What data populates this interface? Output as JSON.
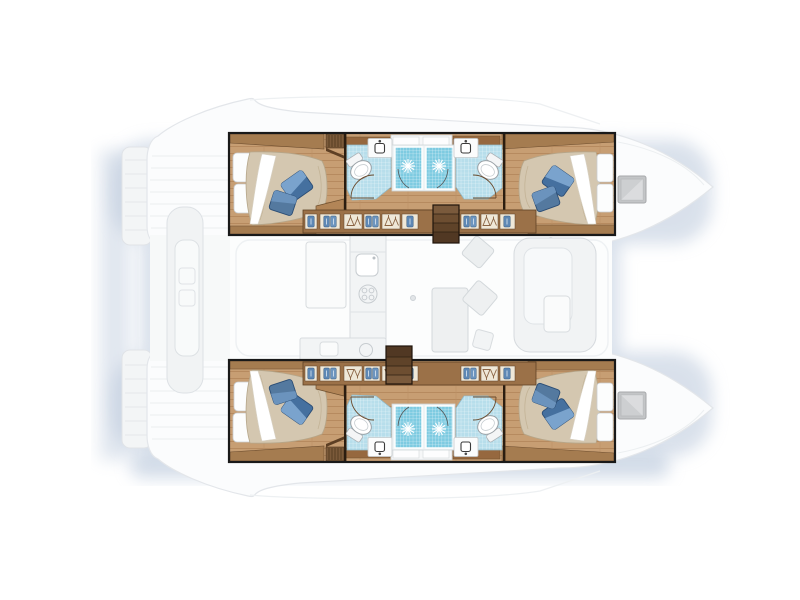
{
  "diagram": {
    "type": "yacht-floor-plan",
    "vessel": "sailing-catamaran",
    "view": "top-down accommodation and deck plan",
    "orientation": "bows-pointing-right",
    "hulls": [
      {
        "name": "port-hull-top",
        "spaces": [
          "aft double cabin with berth and pillows",
          "aft head with sink and toilet",
          "two shower stalls",
          "forward head with sink and toilet",
          "forward double cabin with berth and pillows",
          "corridor with hanging lockers",
          "companionway steps"
        ]
      },
      {
        "name": "starboard-hull-bottom",
        "spaces": [
          "aft double cabin with berth and pillows",
          "aft head with sink and toilet",
          "two shower stalls",
          "forward head with sink and toilet",
          "forward double cabin with berth and pillows",
          "corridor with hanging lockers",
          "companionway steps"
        ]
      }
    ],
    "bridge_deck": {
      "rendering": "ghosted",
      "spaces": [
        "salon",
        "galley with sink and stove",
        "dining table with chairs",
        "l-shaped sofa",
        "aft cockpit bench and table",
        "twin stern swim platforms",
        "foredeck with deck hatches"
      ]
    },
    "counts": {
      "double_berths": 4,
      "shower_stalls": 4,
      "toilets": 4,
      "head_sinks": 4,
      "deck_hatches": 2,
      "companionway_steps": 2
    }
  },
  "colors": {
    "background": "#ffffff",
    "shadow": "#b4c3d8",
    "deck_fill": "#fbfcfd",
    "deck_line": "#e3e6ea",
    "ghost_fill": "#f1f3f4",
    "ghost_line": "#dde1e5",
    "outline_black": "#191919",
    "wood_floor": "#c79e73",
    "wood_plank": "#b2865a",
    "wood_trim": "#a57c50",
    "wood_dark": "#7b5a3a",
    "wood_edge": "#6e4e2f",
    "steps_light": "#7a5a3c",
    "steps_dark": "#513823",
    "mattress": "#d4c7b0",
    "sheet_white": "#ffffff",
    "pillow_white": "#fcfdfd",
    "pillow_blue_light": "#7aa3cd",
    "pillow_blue": "#45709f",
    "pillow_blue_mid": "#54799f",
    "head_tile": "#b7deeb",
    "shower_tile": "#7ecbe1",
    "porcelain": "#ffffff",
    "porcelain_line": "#9aa1a6",
    "locker_row": "#9b7148",
    "locker_cell": "#efe8d8",
    "towel_blue": "#5e88b5",
    "hatch_gray": "#c3c5c7"
  }
}
